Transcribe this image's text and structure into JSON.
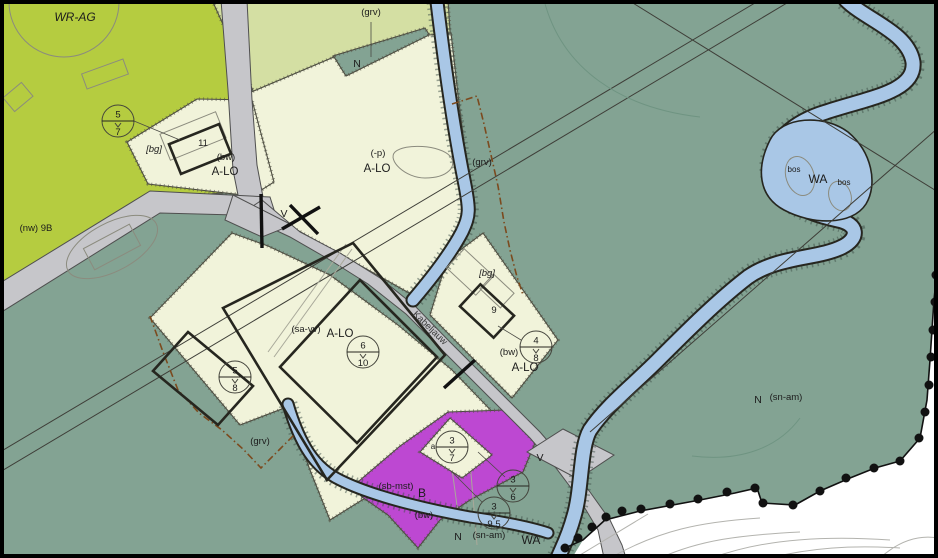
{
  "map": {
    "street": "Kabeljauw",
    "labels": {
      "wr_ag": "WR-AG",
      "grv_top": "(grv)",
      "n_top": "N",
      "p_min": "(-p)",
      "alo_north": "A-LO",
      "grv_east": "(grv)",
      "bg_west": "[bg]",
      "huisnr_11": "11",
      "bw_west": "(bw)",
      "alo_west": "A-LO",
      "nw_9b": "(nw) 9B",
      "sa_vv": "(sa-vv)",
      "alo_central": "A-LO",
      "v_north": "V",
      "v_south": "V",
      "bg_east": "[bg]",
      "huisnr_9": "9",
      "bw_east": "(bw)",
      "alo_east": "A-LO",
      "grv_sw": "(grv)",
      "sb_mst": "(sb-mst)",
      "b_zone": "B",
      "bw_b": "(bw)",
      "n_south": "N",
      "sn_am_south": "(sn-am)",
      "wa_south": "WA",
      "n_east": "N",
      "sn_am_east": "(sn-am)",
      "wa_river": "WA",
      "bos_1": "bos",
      "bos_2": "bos",
      "a_small": "a"
    },
    "measures": [
      {
        "top": "5",
        "bottom": "7"
      },
      {
        "top": "5",
        "bottom": "8"
      },
      {
        "top": "6",
        "bottom": "10"
      },
      {
        "top": "4",
        "bottom": "8"
      },
      {
        "top": "3",
        "bottom": "7"
      },
      {
        "top": "3",
        "bottom": "6"
      },
      {
        "top": "3",
        "bottom": "9,5"
      }
    ],
    "colors": {
      "wr_ag": "#b5cc40",
      "pale_green": "#d4dfa3",
      "a_lo": "#f1f3da",
      "n_sage": "#83a393",
      "water": "#a9c7e6",
      "b_purple": "#bd48d2",
      "road": "#c6c6ca",
      "outside": "#ffffff"
    }
  }
}
